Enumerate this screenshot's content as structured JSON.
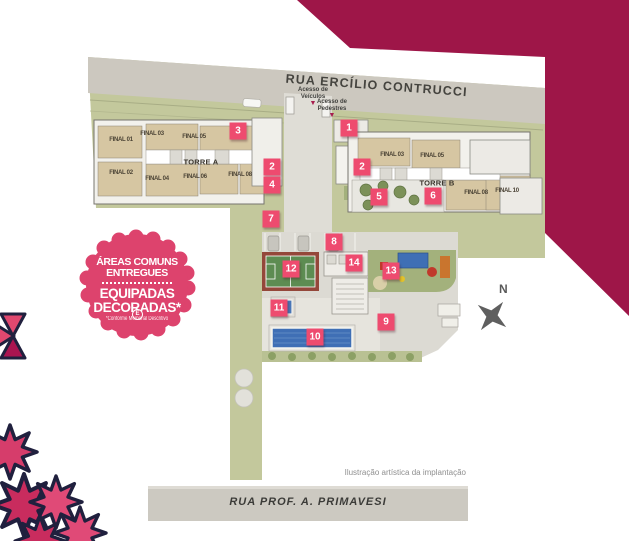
{
  "title": "Implantação do empreendimento - Torres A e B",
  "streets": {
    "top": "RUA ERCÍLIO CONTRUCCI",
    "bottom": "RUA PROF. A. PRIMAVESI"
  },
  "access": {
    "vehicles_line1": "Acesso de",
    "vehicles_line2": "Veículos",
    "pedestrians_line1": "Acesso de",
    "pedestrians_line2": "Pedestres",
    "arrow_icon": "down-triangle"
  },
  "towers": {
    "a": {
      "name": "TORRE A",
      "units": [
        "FINAL 01",
        "FINAL 03",
        "FINAL 05",
        "FINAL 02",
        "FINAL 04",
        "FINAL 06",
        "FINAL 08"
      ]
    },
    "b": {
      "name": "TORRE B",
      "units": [
        "FINAL 03",
        "FINAL 05",
        "FINAL 08",
        "FINAL 10"
      ]
    }
  },
  "markers": [
    "1",
    "3",
    "2",
    "2",
    "4",
    "5",
    "6",
    "7",
    "8",
    "14",
    "12",
    "13",
    "11",
    "9",
    "10"
  ],
  "badge": {
    "line1": "ÁREAS COMUNS",
    "line2": "ENTREGUES",
    "line3": "EQUIPADAS",
    "line4": "E",
    "line5": "DECORADAS*",
    "footnote": "*Conforme Memorial Descritivo"
  },
  "compass": {
    "label": "N"
  },
  "caption": "Ilustração artística da implantação",
  "colors": {
    "brand_magenta": "#9e1648",
    "marker_pink": "#ee4b6f",
    "badge_pink": "#dd436d",
    "site_green": "#c3c89c",
    "street_gray": "#ccc8bf",
    "pool_blue": "#3f6fb5",
    "court_green": "#5d8c52",
    "court_border": "#94473a",
    "decor_pink": "#e0486f",
    "decor_dark_pink": "#b51e54",
    "outline_navy": "#20203e"
  }
}
